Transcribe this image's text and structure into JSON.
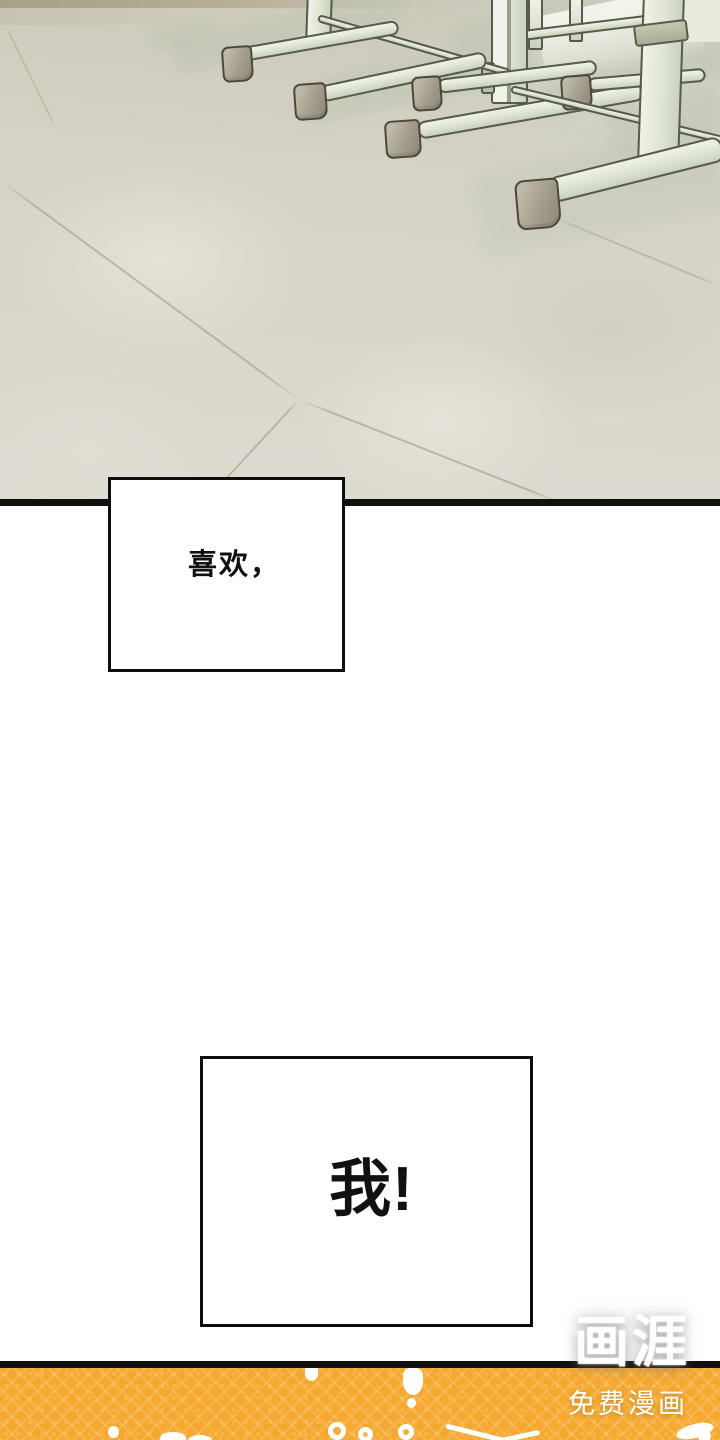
{
  "theme": {
    "floor-base": "#d5d3c6",
    "floor-light": "#dedcd2",
    "wall-strip": "#a7a189",
    "desk-fill": "#dde3d3",
    "desk-edge": "#565b4b",
    "foot-fill": "#a49e8e",
    "foot-edge": "#4c473a",
    "grout": "#ad9d85",
    "shadow": "#bfc5b4",
    "divider": "#101010",
    "ink": "#111111",
    "banner-orange": "#f6a930",
    "white": "#ffffff"
  },
  "panels": {
    "speech1": "喜欢，",
    "speech2": "我!"
  },
  "watermark": {
    "logo": "画涯",
    "subtitle": "免费漫画"
  }
}
